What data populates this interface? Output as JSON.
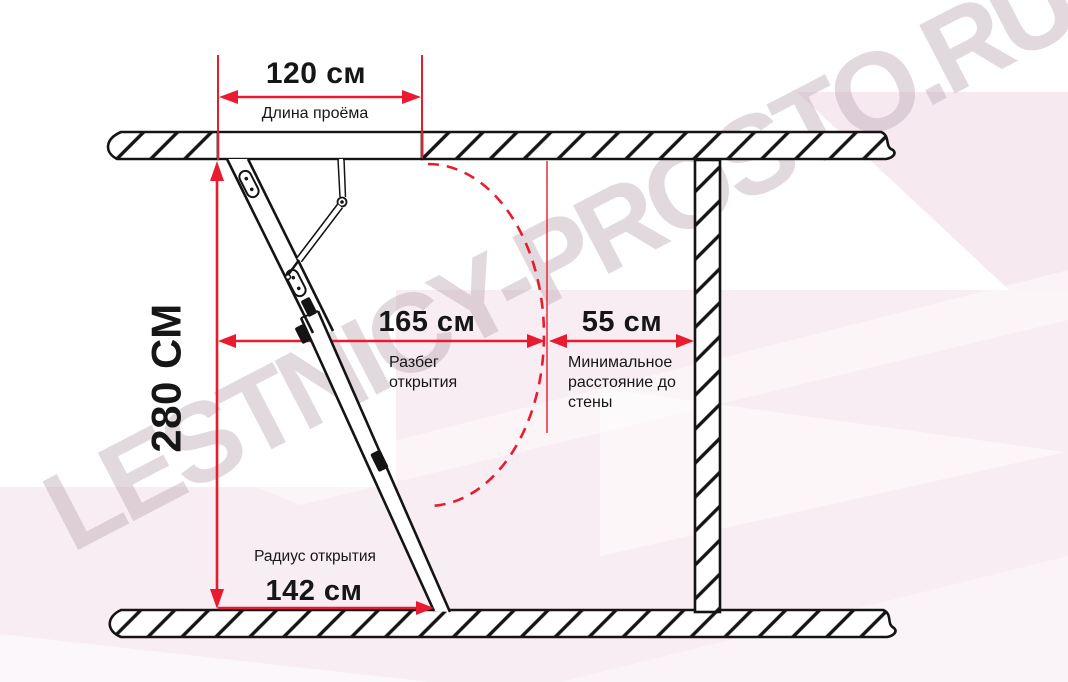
{
  "watermark": {
    "text": "LESTNICY-PROSTO.RU"
  },
  "colors": {
    "accent_red": "#e81c2e",
    "line_black": "#141414",
    "pink_background": "#f8edf3",
    "pink_triangle": "#f6e9f0",
    "watermark_color": "rgba(190,170,182,0.45)"
  },
  "dimensions": {
    "opening_width": {
      "value": "120 см",
      "label": "Длина проёма"
    },
    "ceiling_height": {
      "value": "280 СМ"
    },
    "opening_span": {
      "value": "165 см",
      "label": "Разбег открытия"
    },
    "wall_distance": {
      "value": "55 см",
      "label": "Минимальное расстояние до стены"
    },
    "opening_radius": {
      "value": "142 см",
      "label": "Радиус открытия"
    }
  }
}
